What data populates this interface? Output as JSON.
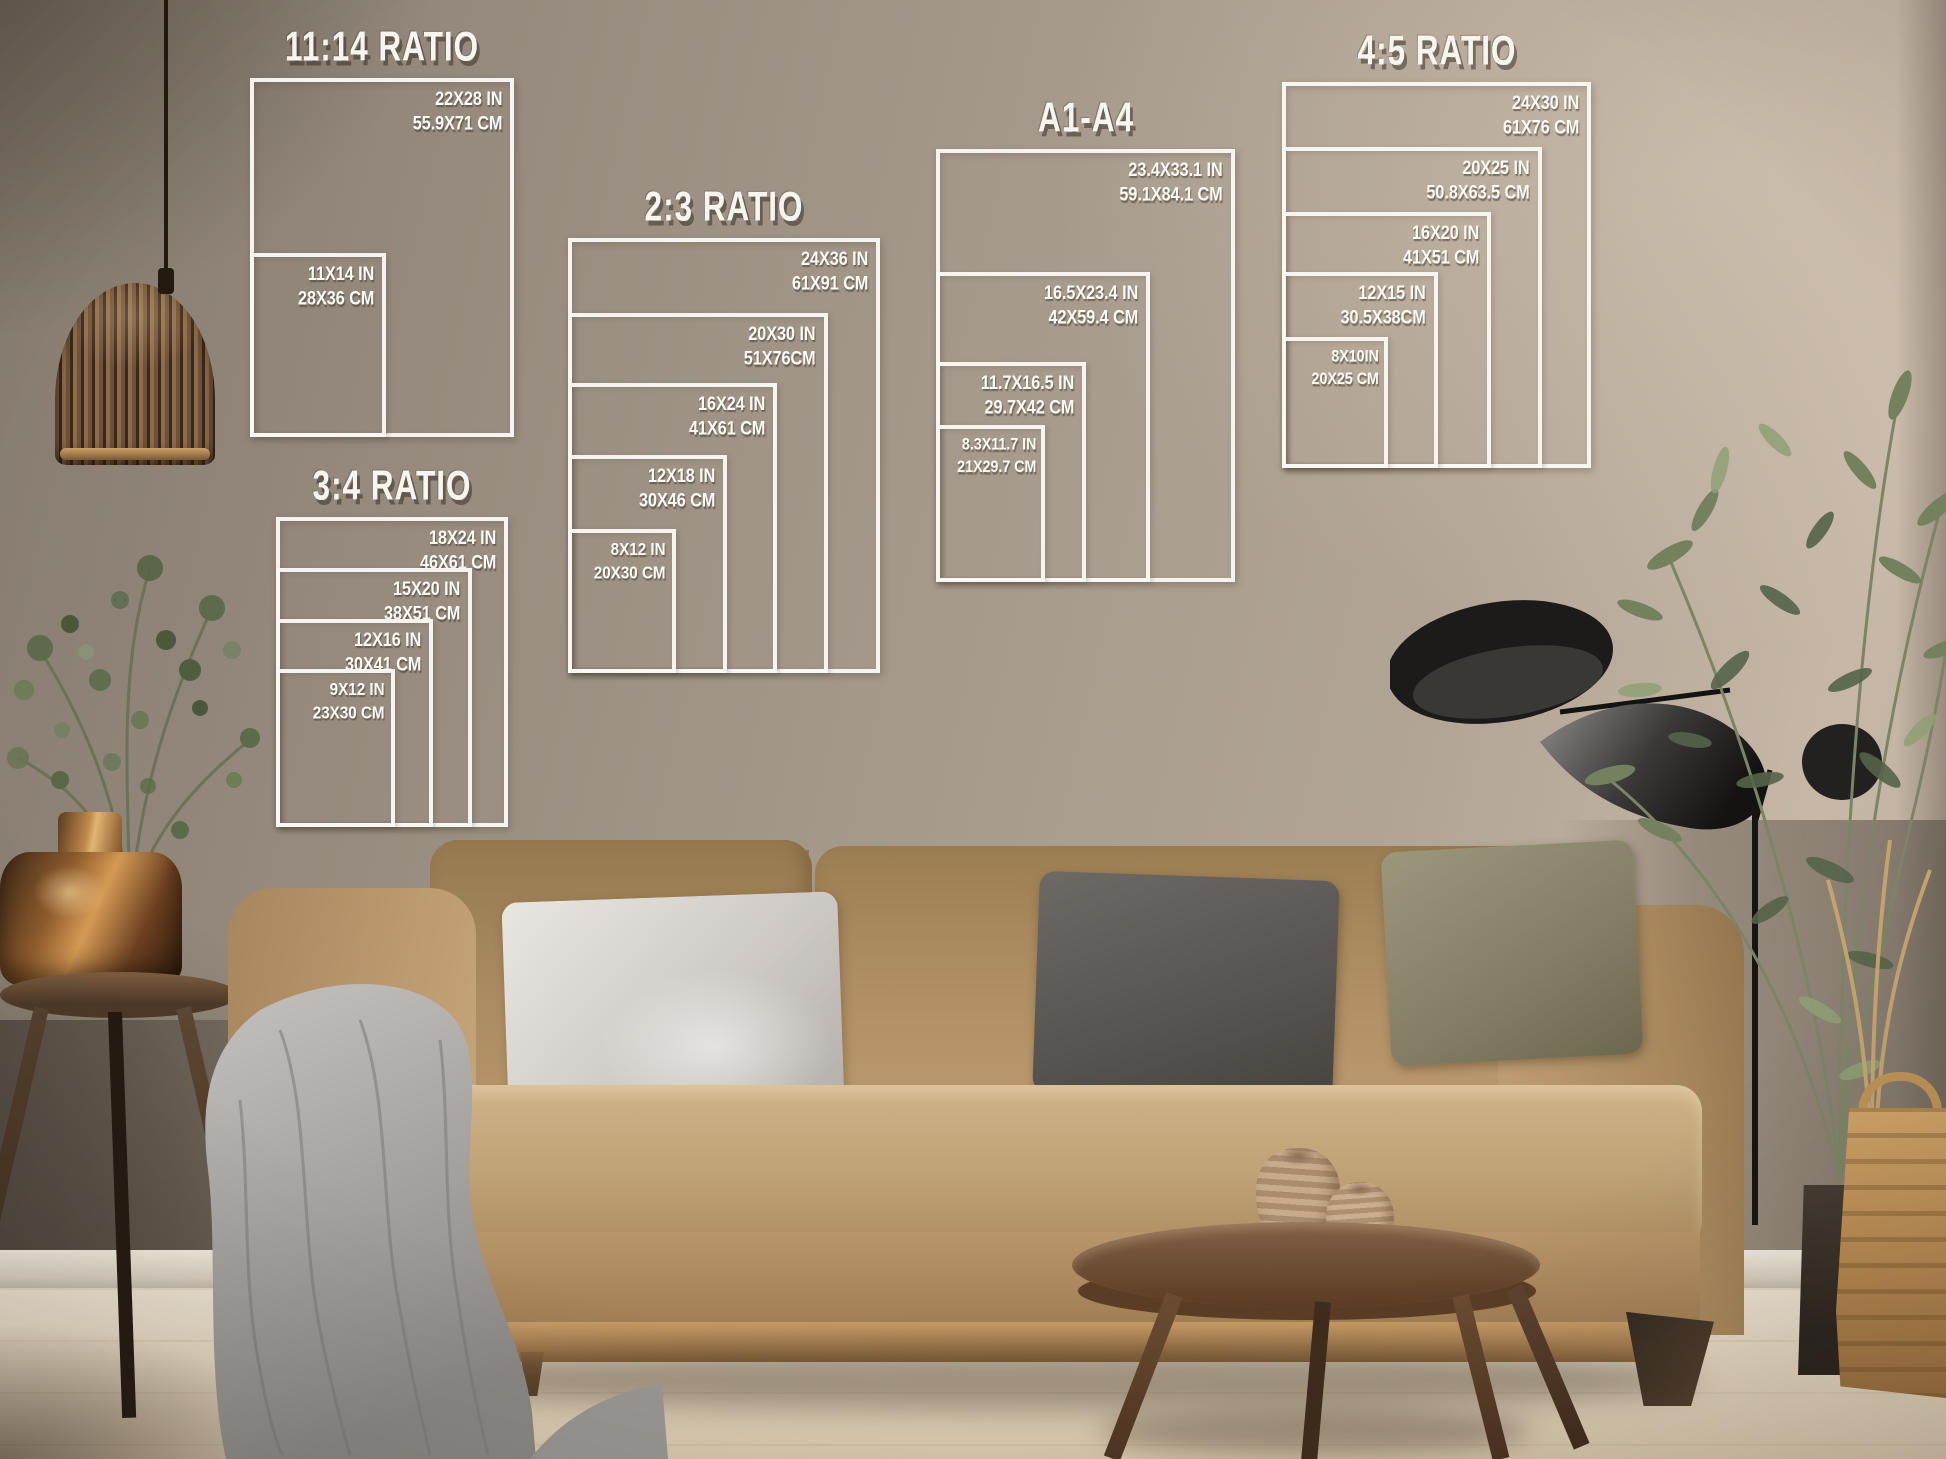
{
  "charts": [
    {
      "title": "11:14 RATIO",
      "sizes": [
        {
          "inches": "22X28 IN",
          "cm": "55.9X71 CM"
        },
        {
          "inches": "11X14 IN",
          "cm": "28X36 CM"
        }
      ]
    },
    {
      "title": "2:3 RATIO",
      "sizes": [
        {
          "inches": "24X36 IN",
          "cm": "61X91 CM"
        },
        {
          "inches": "20X30 IN",
          "cm": "51X76CM"
        },
        {
          "inches": "16X24 IN",
          "cm": "41X61 CM"
        },
        {
          "inches": "12X18 IN",
          "cm": "30X46 CM"
        },
        {
          "inches": "8X12 IN",
          "cm": "20X30 CM"
        }
      ]
    },
    {
      "title": "3:4 RATIO",
      "sizes": [
        {
          "inches": "18X24 IN",
          "cm": "46X61 CM"
        },
        {
          "inches": "15X20 IN",
          "cm": "38X51 CM"
        },
        {
          "inches": "12X16 IN",
          "cm": "30X41 CM"
        },
        {
          "inches": "9X12 IN",
          "cm": "23X30 CM"
        }
      ]
    },
    {
      "title": "A1-A4",
      "sizes": [
        {
          "inches": "23.4X33.1 IN",
          "cm": "59.1X84.1 CM"
        },
        {
          "inches": "16.5X23.4 IN",
          "cm": "42X59.4 CM"
        },
        {
          "inches": "11.7X16.5 IN",
          "cm": "29.7X42 CM"
        },
        {
          "inches": "8.3X11.7 IN",
          "cm": "21X29.7 CM"
        }
      ]
    },
    {
      "title": "4:5 RATIO",
      "sizes": [
        {
          "inches": "24X30 IN",
          "cm": "61X76 CM"
        },
        {
          "inches": "20X25 IN",
          "cm": "50.8X63.5 CM"
        },
        {
          "inches": "16X20 IN",
          "cm": "41X51 CM"
        },
        {
          "inches": "12X15 IN",
          "cm": "30.5X38CM"
        },
        {
          "inches": "8X10IN",
          "cm": "20X25 CM"
        }
      ]
    }
  ],
  "scene": {
    "colors": {
      "overlay_white": "#f8f5ef",
      "wall_taupe": "#a59a8c",
      "sofa_tan": "#b5936a",
      "pillow_silver": "#d6d2cd",
      "pillow_charcoal": "#57534f",
      "pillow_olive": "#8f8a70",
      "copper_vase": "#a06a35",
      "wood_dark": "#5e3f28"
    }
  }
}
